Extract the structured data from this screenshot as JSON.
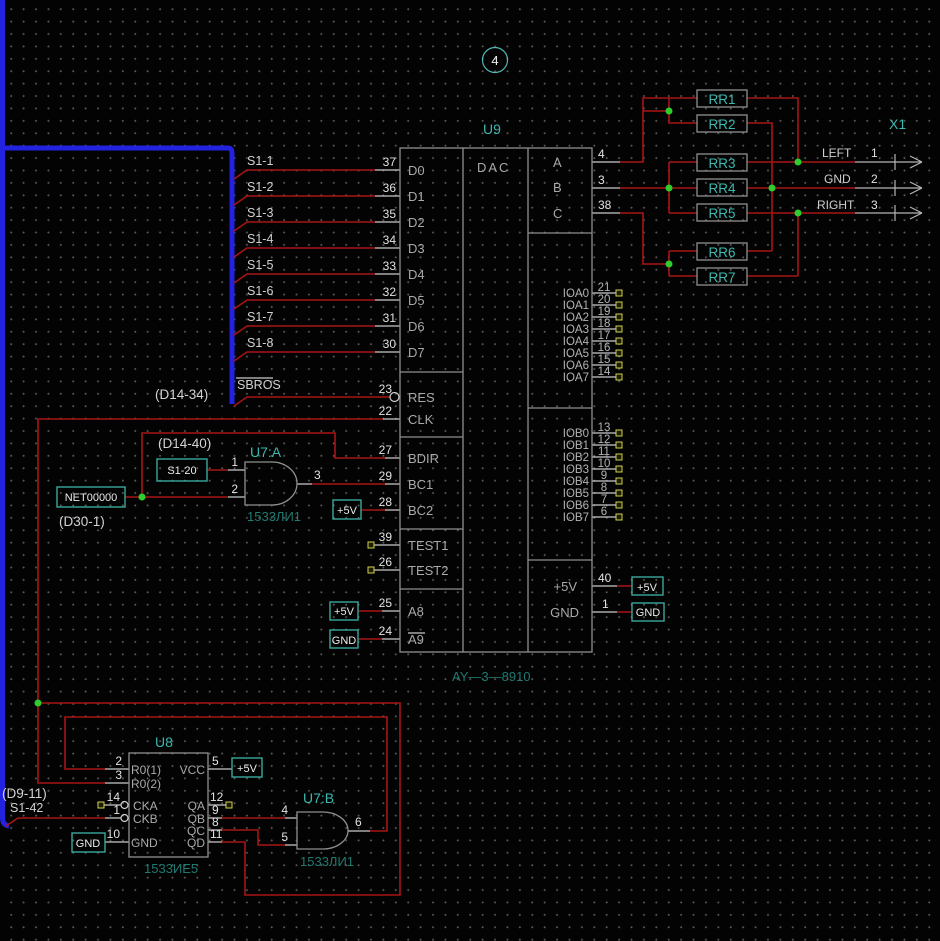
{
  "sheet": {
    "page": "4"
  },
  "colors": {
    "wire": "#a81414",
    "bus": "#2222e0",
    "ref": "#3cb8b0",
    "junction": "#2ecc2e",
    "pad": "#d2d24e"
  },
  "labels": {
    "d14_34": "(D14-34)",
    "d14_40": "(D14-40)",
    "d30_1": "(D30-1)",
    "d9_11": "(D9-11)",
    "s1_42": "S1-42",
    "sbros": "SBROS",
    "net00000": "NET00000",
    "s1_20": "S1-20"
  },
  "power": {
    "p5": "+5V",
    "gnd": "GND"
  },
  "s1": [
    "S1-1",
    "S1-2",
    "S1-3",
    "S1-4",
    "S1-5",
    "S1-6",
    "S1-7",
    "S1-8"
  ],
  "u9": {
    "ref": "U9",
    "part": "AY—3—8910",
    "core": "DAC",
    "left": [
      {
        "num": "37",
        "name": "D0"
      },
      {
        "num": "36",
        "name": "D1"
      },
      {
        "num": "35",
        "name": "D2"
      },
      {
        "num": "34",
        "name": "D3"
      },
      {
        "num": "33",
        "name": "D4"
      },
      {
        "num": "32",
        "name": "D5"
      },
      {
        "num": "31",
        "name": "D6"
      },
      {
        "num": "30",
        "name": "D7"
      },
      {
        "num": "23",
        "name": "RES"
      },
      {
        "num": "22",
        "name": "CLK"
      },
      {
        "num": "27",
        "name": "BDIR"
      },
      {
        "num": "29",
        "name": "BC1"
      },
      {
        "num": "28",
        "name": "BC2"
      },
      {
        "num": "39",
        "name": "TEST1"
      },
      {
        "num": "26",
        "name": "TEST2"
      },
      {
        "num": "25",
        "name": "A8"
      },
      {
        "num": "24",
        "name": "A9"
      }
    ],
    "abc": [
      {
        "num": "4",
        "name": "A"
      },
      {
        "num": "3",
        "name": "B"
      },
      {
        "num": "38",
        "name": "C"
      }
    ],
    "ioa": [
      {
        "num": "21",
        "name": "IOA0"
      },
      {
        "num": "20",
        "name": "IOA1"
      },
      {
        "num": "19",
        "name": "IOA2"
      },
      {
        "num": "18",
        "name": "IOA3"
      },
      {
        "num": "17",
        "name": "IOA4"
      },
      {
        "num": "16",
        "name": "IOA5"
      },
      {
        "num": "15",
        "name": "IOA6"
      },
      {
        "num": "14",
        "name": "IOA7"
      }
    ],
    "iob": [
      {
        "num": "13",
        "name": "IOB0"
      },
      {
        "num": "12",
        "name": "IOB1"
      },
      {
        "num": "11",
        "name": "IOB2"
      },
      {
        "num": "10",
        "name": "IOB3"
      },
      {
        "num": "9",
        "name": "IOB4"
      },
      {
        "num": "8",
        "name": "IOB5"
      },
      {
        "num": "7",
        "name": "IOB6"
      },
      {
        "num": "6",
        "name": "IOB7"
      }
    ],
    "pwr": [
      {
        "num": "40",
        "name": "+5V"
      },
      {
        "num": "1",
        "name": "GND"
      }
    ]
  },
  "u7a": {
    "ref": "U7:A",
    "part": "1533ЛИ1",
    "in1": "1",
    "in2": "2",
    "out": "3"
  },
  "u7b": {
    "ref": "U7:B",
    "part": "1533ЛИ1",
    "in1": "4",
    "in2": "5",
    "out": "6"
  },
  "u8": {
    "ref": "U8",
    "part": "1533ИЕ5",
    "left": [
      {
        "num": "2",
        "name": "R0(1)"
      },
      {
        "num": "3",
        "name": "R0(2)"
      },
      {
        "num": "14",
        "name": "CKA"
      },
      {
        "num": "1",
        "name": "CKB"
      },
      {
        "num": "10",
        "name": "GND"
      }
    ],
    "right": [
      {
        "num": "5",
        "name": "VCC"
      },
      {
        "num": "12",
        "name": "QA"
      },
      {
        "num": "9",
        "name": "QB"
      },
      {
        "num": "8",
        "name": "QC"
      },
      {
        "num": "11",
        "name": "QD"
      }
    ]
  },
  "resistors": [
    "RR1",
    "RR2",
    "RR3",
    "RR4",
    "RR5",
    "RR6",
    "RR7"
  ],
  "x1": {
    "ref": "X1",
    "pins": [
      {
        "name": "LEFT",
        "num": "1"
      },
      {
        "name": "GND",
        "num": "2"
      },
      {
        "name": "RIGHT",
        "num": "3"
      }
    ]
  }
}
